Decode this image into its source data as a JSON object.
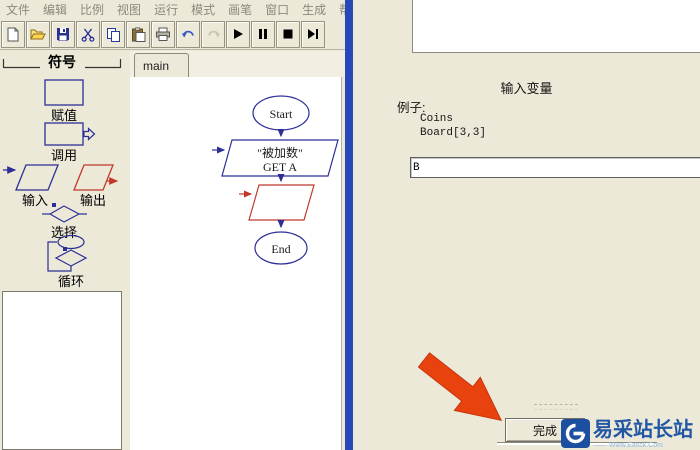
{
  "window": {
    "menu": {
      "items": [
        "文件",
        "编辑",
        "比例",
        "视图",
        "运行",
        "模式",
        "画笔",
        "窗口",
        "生成",
        "帮助"
      ]
    },
    "toolbar": {
      "icons": [
        "new-document",
        "open-folder",
        "save",
        "cut",
        "copy",
        "paste",
        "print",
        "undo",
        "redo",
        "play",
        "pause",
        "stop",
        "step-to-end"
      ]
    }
  },
  "sidebar": {
    "header": "符号",
    "symbols": [
      {
        "label": "赋值",
        "shape": "rectangle"
      },
      {
        "label": "调用",
        "shape": "rectangle-with-out-arrow"
      },
      {
        "label": "输入",
        "shape": "parallelogram-blue"
      },
      {
        "label": "输出",
        "shape": "parallelogram-red"
      },
      {
        "label": "选择",
        "shape": "diamond"
      },
      {
        "label": "循环",
        "shape": "oval-diamond-loop"
      }
    ]
  },
  "tabs": {
    "active": "main"
  },
  "flowchart": {
    "start_label": "Start",
    "io_step": {
      "line1": "\"被加数\"",
      "line2": "GET A"
    },
    "end_label": "End"
  },
  "dialog": {
    "title": "输入变量",
    "example_label": "例子:",
    "examples": [
      "Coins",
      "Board[3,3]"
    ],
    "input_value": "B",
    "finish_label": "完成"
  },
  "watermark": {
    "text": "易采站长站",
    "subtext": "—— Www.Easck.Com"
  },
  "colors": {
    "window_bg": "#ece9d8",
    "blue_edge": "#2847b8",
    "flow_blue": "#2c2f96",
    "flow_red": "#c0392b",
    "annotation_arrow": "#e8430f",
    "watermark_blue": "#1d4fa0"
  }
}
